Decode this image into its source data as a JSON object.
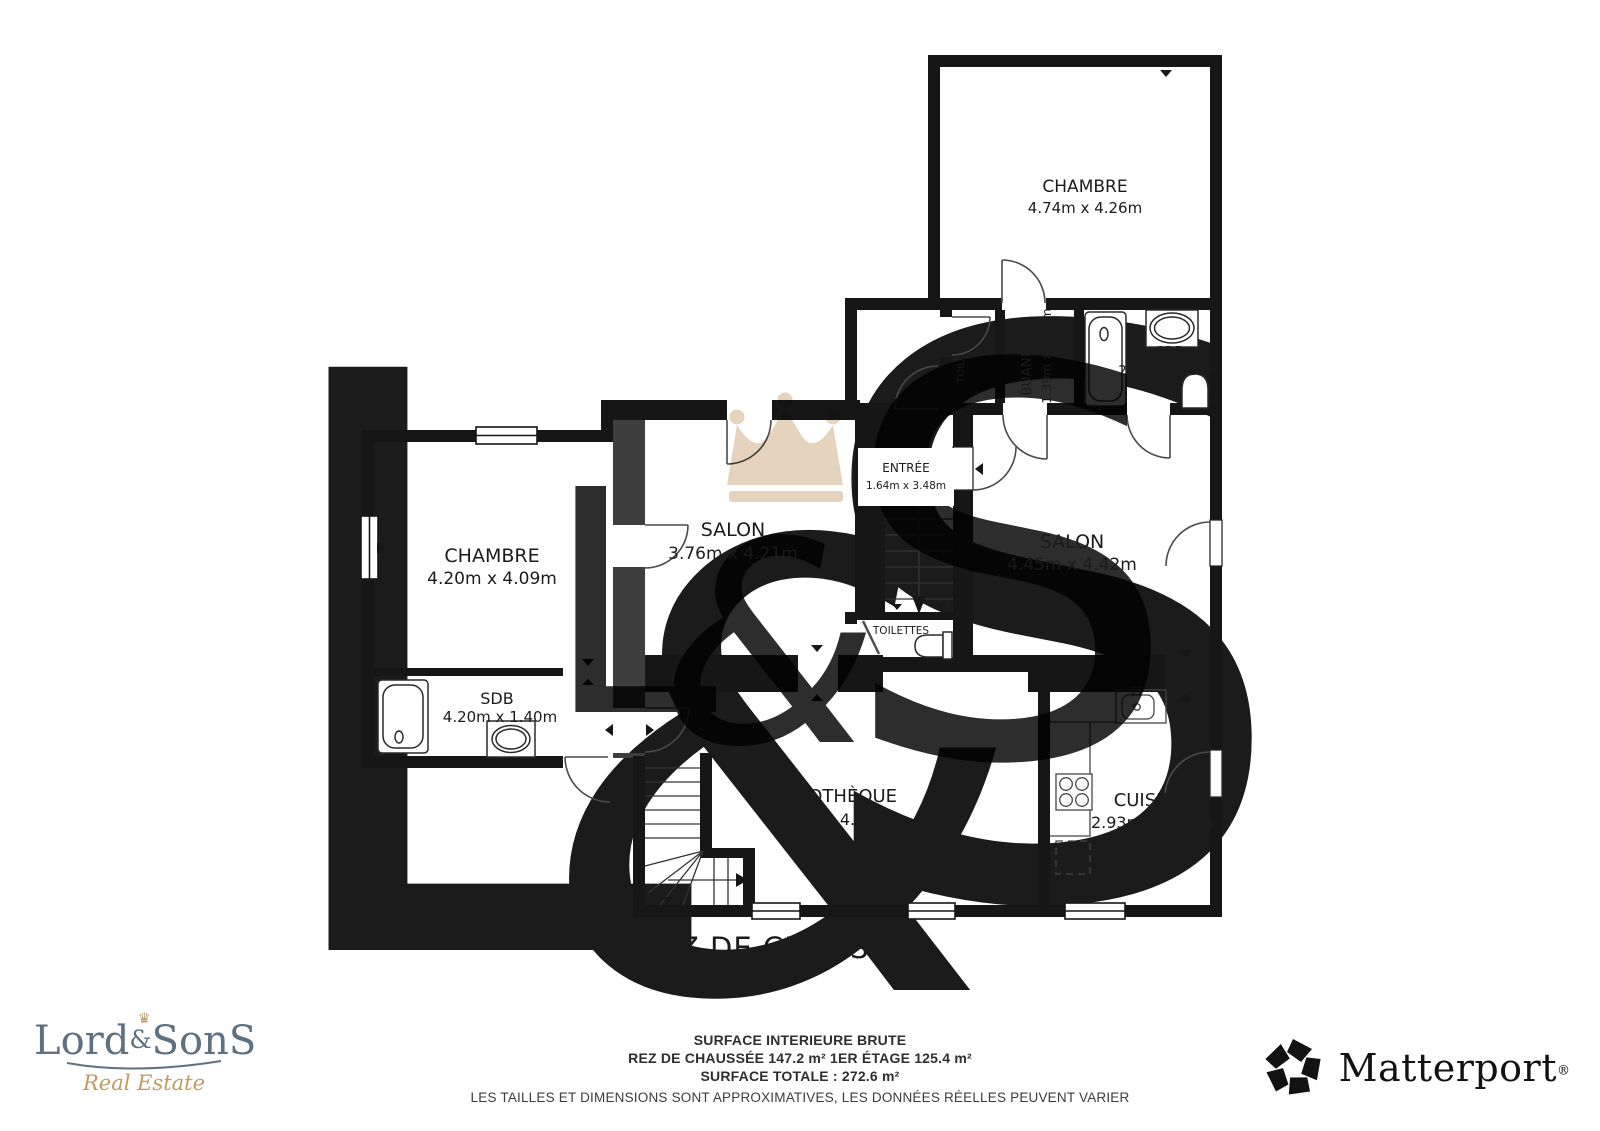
{
  "floor_title": "REZ DE CHAUSSÉE",
  "rooms": {
    "chambre_tr": {
      "name": "CHAMBRE",
      "dims": "4.74m x 4.26m"
    },
    "sdb_tr": {
      "name": "SDB",
      "dims": "2.46m x 1.80m"
    },
    "buanderie": {
      "name": "BUANDERIE",
      "dims": "1.39m x 1.80m"
    },
    "toilettes_tr": {
      "name": "TOILETTES"
    },
    "entree": {
      "name": "ENTRÉE",
      "dims": "1.64m x 3.48m"
    },
    "salon_mid": {
      "name": "SALON",
      "dims": "3.76m x 4.21m"
    },
    "salon_right": {
      "name": "SALON",
      "dims": "4.45m x 4.42m"
    },
    "chambre_left": {
      "name": "CHAMBRE",
      "dims": "4.20m x 4.09m"
    },
    "sdb_left": {
      "name": "SDB",
      "dims": "4.20m x 1.40m"
    },
    "toilettes_mid": {
      "name": "TOILETTES"
    },
    "bibliotheque": {
      "name": "BIBLIOTHÈQUE",
      "dims": "7.01m x 4.07m"
    },
    "cuisine": {
      "name": "CUISINE",
      "dims": "2.93m x 4.07m"
    }
  },
  "footer": {
    "line1": "SURFACE INTERIEURE BRUTE",
    "line2": "REZ DE CHAUSSÉE 147.2 m²   1ER ÉTAGE 125.4 m²",
    "line3": "SURFACE TOTALE :  272.6 m²",
    "disclaimer": "LES TAILLES ET DIMENSIONS SONT APPROXIMATIVES, LES DONNÉES RÉELLES PEUVENT VARIER"
  },
  "watermark": {
    "letter_l": "L",
    "letter_amp": "&",
    "letter_s": "S"
  },
  "branding": {
    "agency": {
      "lord": "Lord",
      "amp": "&",
      "sons": "SonS",
      "crown": "♛",
      "tagline": "Real Estate"
    },
    "matterport": {
      "name": "Matterport",
      "reg": "®"
    }
  },
  "colors": {
    "wall_black": "#161616",
    "wall_gray": "#3e3e3e",
    "watermark_beige": "#e3d0b8",
    "watermark_pale": "#f5efe6",
    "agency_blue": "#5d7183",
    "agency_gold": "#c29a5d"
  }
}
